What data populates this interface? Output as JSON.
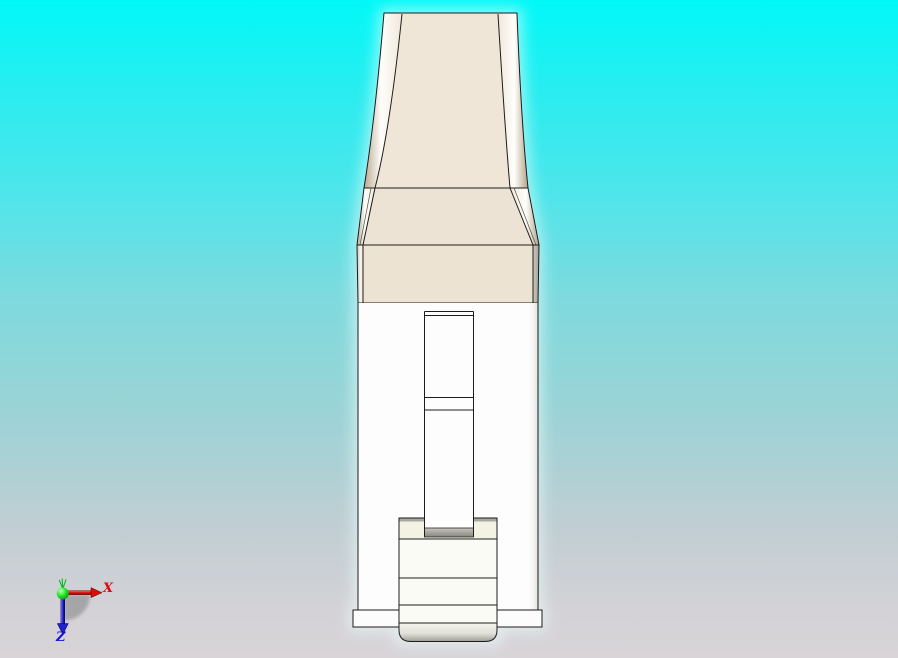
{
  "viewport": {
    "type": "3d-cad-viewport",
    "background_gradient_top": "#02f8f8",
    "background_gradient_bottom": "#d8d4d8",
    "model": {
      "description": "white and beige connector block, front elevation",
      "lever_face_color": "#ece3d3",
      "body_color": "#fdfdfd",
      "latch_ivory_color": "#f3f3e4",
      "hardware_gray_color": "#a9a9a1",
      "outline_color": "#1c1c1c"
    },
    "orientation_triad": {
      "x_axis": {
        "label": "X",
        "color": "#e00714"
      },
      "y_axis": {
        "color": "#00bb22"
      },
      "z_axis": {
        "label": "Z",
        "color": "#1515cf"
      },
      "origin_color": "#22dd22",
      "shadow_color": "#7a7a7a"
    }
  }
}
